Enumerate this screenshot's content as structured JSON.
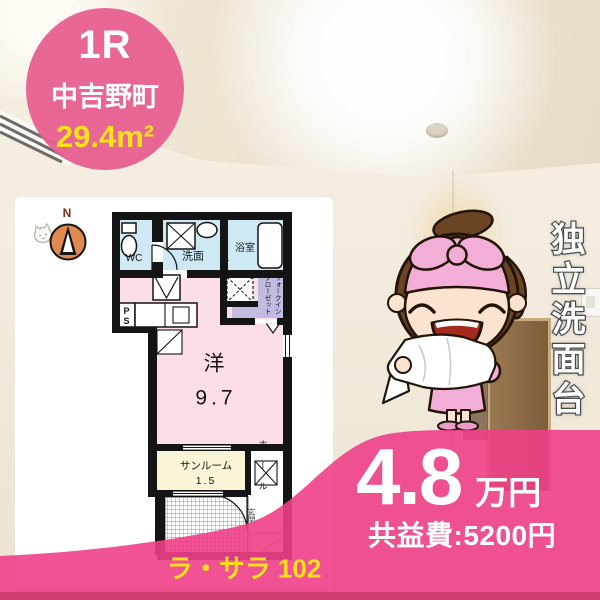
{
  "badge": {
    "layout": "1R",
    "area": "中吉野町",
    "size": "29.4m²"
  },
  "floorplan": {
    "compass": "N",
    "wc": "WC",
    "washroom": "洗面",
    "bath": "浴室",
    "closet": "ウォークインクローゼット",
    "ps": "PS",
    "main_room": "洋",
    "main_size": "9.7",
    "sunroom": "サンルーム",
    "sunroom_size": "1.5",
    "hall": "ホール",
    "entrance": "玄関"
  },
  "feature": {
    "text": "独立洗面台"
  },
  "price": {
    "rent": "4.8",
    "unit": "万円",
    "fee": "共益費:5200円"
  },
  "property": {
    "name": "ラ・サラ 102"
  },
  "colors": {
    "badge_pink": "#e7618f",
    "band_pink": "#ee3f87",
    "accent_yellow": "#ffe11c",
    "plan_blue": "#cfe9f4",
    "plan_pink": "#fbdde8",
    "plan_lavender": "#c3bce2",
    "plan_cream": "#f9f4d6"
  }
}
